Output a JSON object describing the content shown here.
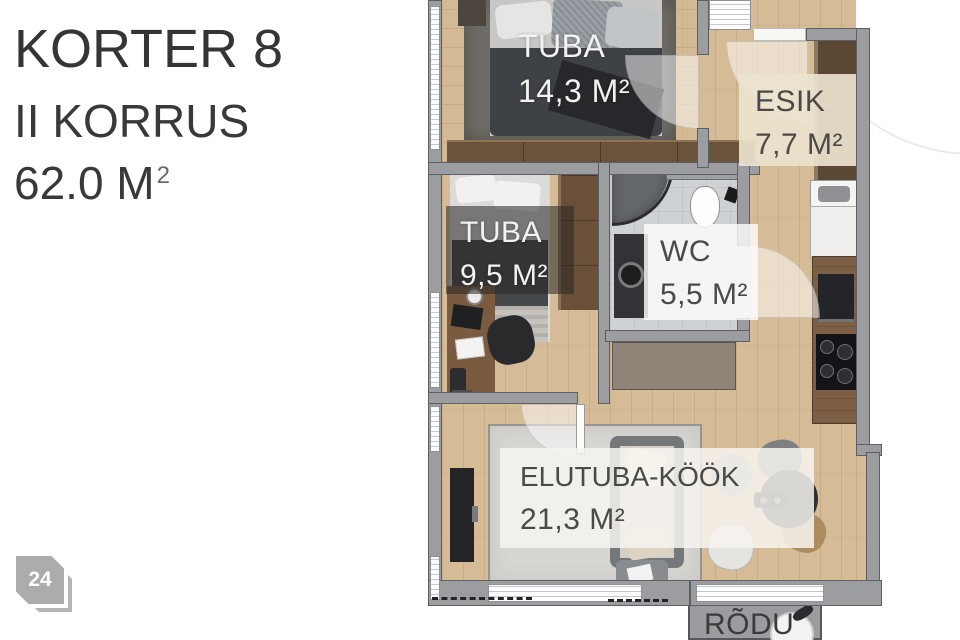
{
  "page": {
    "title": "KORTER 8",
    "subtitle": "II KORRUS",
    "area_value": "62.0 M",
    "area_sup": "2",
    "badge": "24"
  },
  "rooms": {
    "tuba1": {
      "name": "TUBA",
      "area": "14,3 M²"
    },
    "tuba2": {
      "name": "TUBA",
      "area": "9,5 M²"
    },
    "esik": {
      "name": "ESIK",
      "area": "7,7 M²"
    },
    "wc": {
      "name": "WC",
      "area": "5,5 M²"
    },
    "elutuba": {
      "name": "ELUTUBA-KÖÖK",
      "area": "21,3 M²"
    },
    "rodu": {
      "name": "RÕDU",
      "area": ""
    }
  },
  "colors": {
    "wall": "#9B9DA1",
    "wood_floor": "#D5BC97",
    "dark_rug": "#6F6B66",
    "light_rug": "#D8D6D2",
    "tile": "#CFD2D4",
    "label_dark_text": "#4A4A49",
    "label_light_text": "#F3F2F0",
    "overlay_beige": "#EBE3CE",
    "badge_gray": "#ACACAC"
  }
}
